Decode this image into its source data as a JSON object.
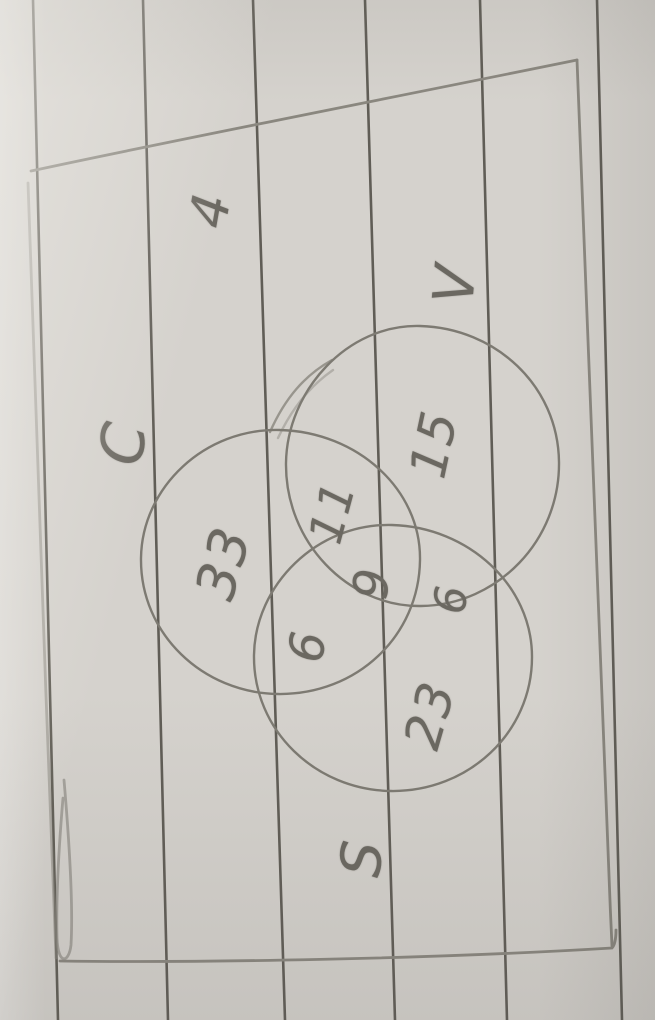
{
  "venn": {
    "labels": {
      "c": "C",
      "v": "V",
      "s": "S"
    },
    "values": {
      "outside": "4",
      "c_only": "33",
      "v_only": "15",
      "s_only": "23",
      "c_v": "11",
      "c_s": "6",
      "v_s": "6",
      "c_v_s": "9"
    }
  },
  "chart_data": {
    "type": "venn",
    "sets": [
      "C",
      "V",
      "S"
    ],
    "region_values": {
      "C_only": 33,
      "V_only": 15,
      "S_only": 23,
      "C_and_V": 11,
      "C_and_S": 6,
      "V_and_S": 6,
      "C_and_V_and_S": 9,
      "outside": 4
    }
  },
  "colors": {
    "paper": "#d5d2cd",
    "ruled_line": "#514d46",
    "pencil_stroke": "#7d7a72",
    "pencil_text": "#6b6861"
  }
}
